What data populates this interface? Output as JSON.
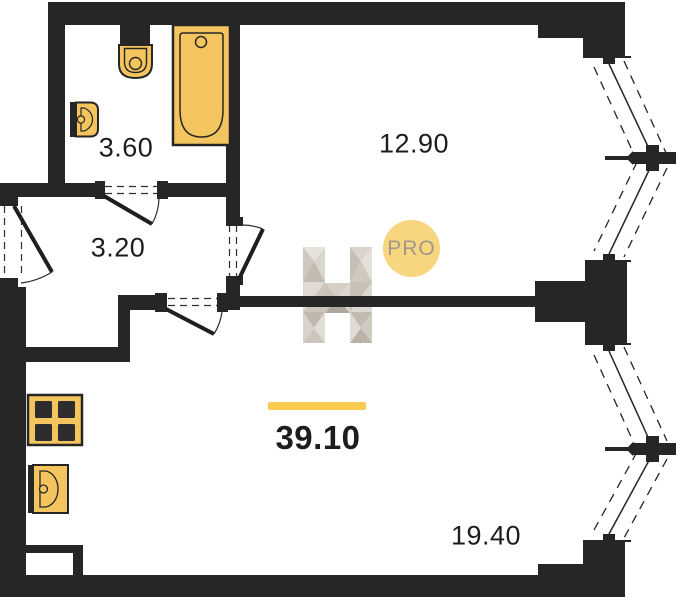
{
  "floorplan": {
    "total": {
      "area": "39.10"
    },
    "rooms": {
      "bathroom": {
        "area": "3.60"
      },
      "hallway": {
        "area": "3.20"
      },
      "room": {
        "area": "12.90"
      },
      "living_kitchen": {
        "area": "19.40"
      }
    },
    "watermark": {
      "badge_text": "PRO"
    },
    "colors": {
      "wall": "#262626",
      "fixture_fill": "#F4C55F",
      "accent_line": "#FBCA4E",
      "badge_bg": "#F8D680",
      "badge_text": "#A1988A",
      "label_text": "#1D1D1D"
    },
    "icons": [
      "toilet-icon",
      "bathtub-icon",
      "bathroom-sink-icon",
      "stove-icon",
      "kitchen-sink-icon",
      "h-logo-watermark-icon",
      "pro-badge"
    ]
  }
}
